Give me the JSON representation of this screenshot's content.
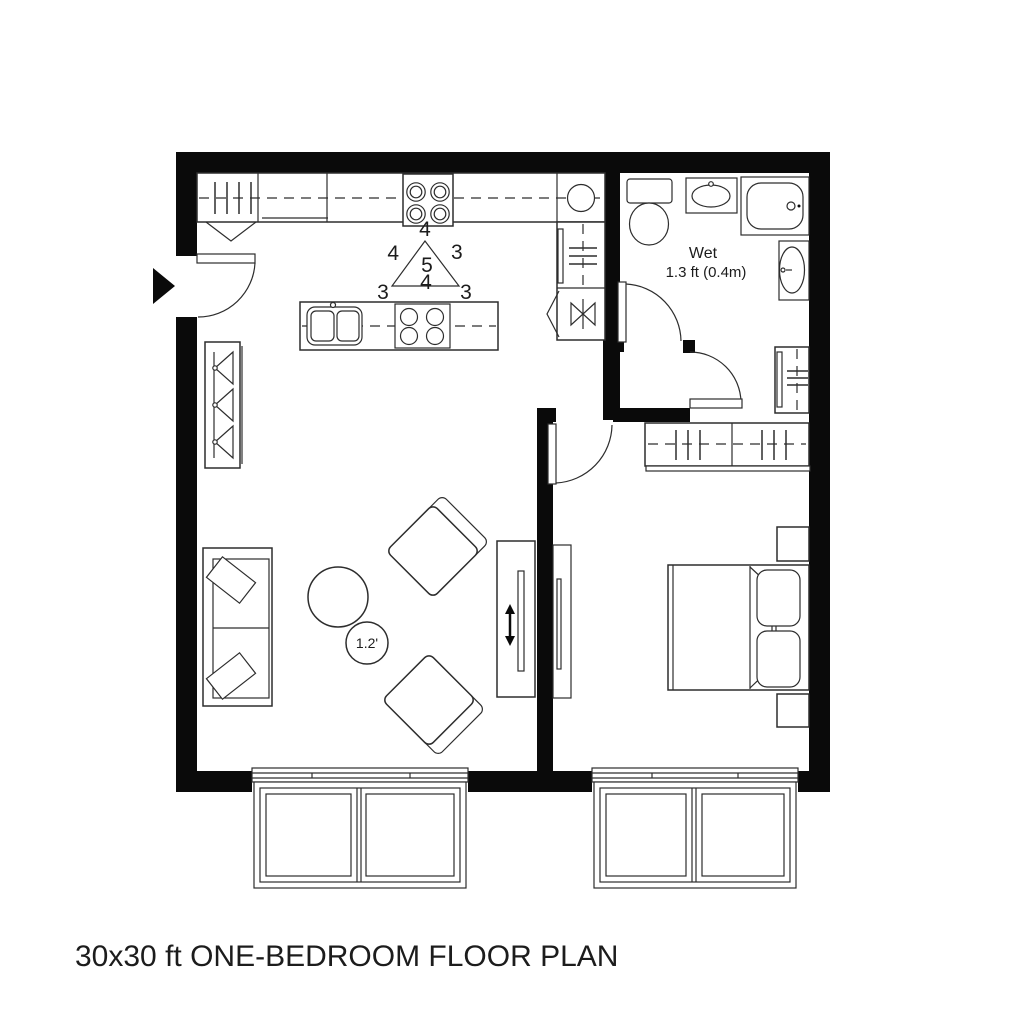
{
  "title": "30x30 ft ONE-BEDROOM FLOOR PLAN",
  "bathroom": {
    "name": "Wet",
    "dimension": "1.3 ft (0.4m)"
  },
  "living_room": {
    "rug_label": "1.2'"
  },
  "kitchen": {
    "work_triangle": {
      "apex": "4",
      "left_side": "4",
      "right_side": "3",
      "center": "5",
      "base": "4",
      "bottom_left": "3",
      "bottom_right": "3"
    }
  },
  "colors": {
    "wall": "#0a0a0a",
    "outline": "#2d2d2d",
    "background": "#ffffff",
    "text": "#1c1c1c"
  }
}
